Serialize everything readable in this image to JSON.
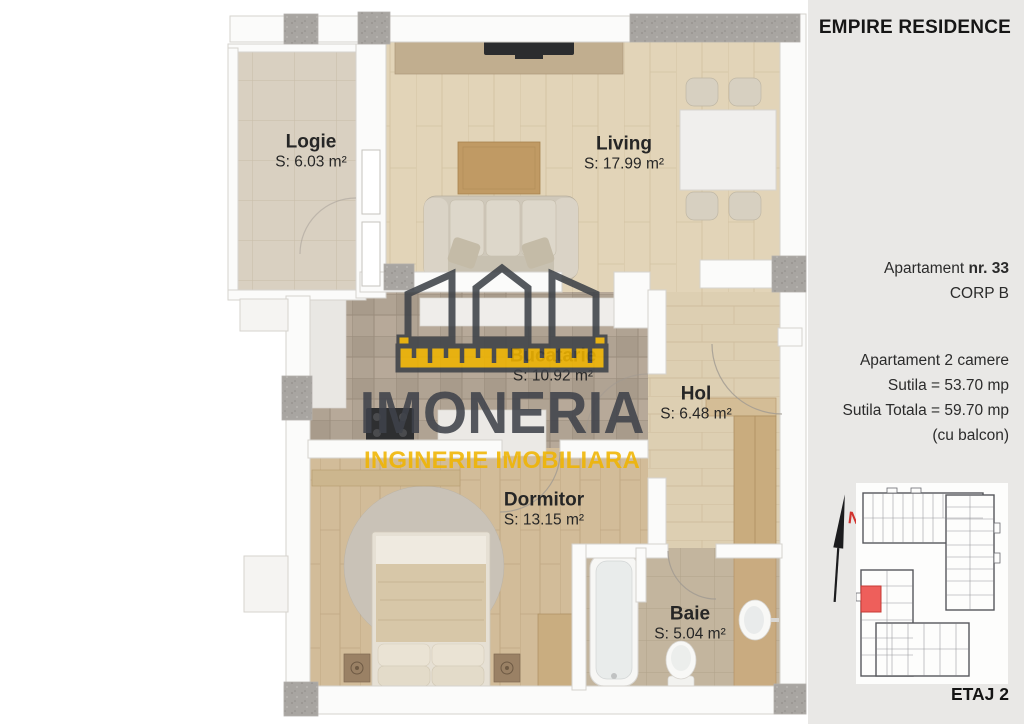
{
  "header": {
    "title": "EMPIRE RESIDENCE"
  },
  "apartment": {
    "name_prefix": "Apartament",
    "number": "nr. 33",
    "corp": "CORP B",
    "type": "Apartament 2 camere",
    "area_usable": "Sutila = 53.70 mp",
    "area_total": "Sutila Totala = 59.70 mp",
    "area_note": "(cu balcon)"
  },
  "floor": {
    "label": "ETAJ 2"
  },
  "compass": {
    "label": "N"
  },
  "watermark": {
    "brand": "IMONERIA",
    "tagline": "INGINERIE IMOBILIARA"
  },
  "rooms": [
    {
      "id": "logie",
      "name": "Logie",
      "area": "S: 6.03 m²"
    },
    {
      "id": "living",
      "name": "Living",
      "area": "S: 17.99 m²"
    },
    {
      "id": "bucatarie",
      "name": "Bucatarie",
      "area": "S: 10.92 m²"
    },
    {
      "id": "hol",
      "name": "Hol",
      "area": "S: 6.48 m²"
    },
    {
      "id": "dormitor",
      "name": "Dormitor",
      "area": "S: 13.15 m²"
    },
    {
      "id": "baie",
      "name": "Baie",
      "area": "S: 5.04 m²"
    }
  ],
  "colors": {
    "accent_yellow": "#f0b400",
    "brand_dark": "#3f434a",
    "unit_highlight_red": "#ee5f5b",
    "sidebar_bg": "#e9e8e6"
  }
}
